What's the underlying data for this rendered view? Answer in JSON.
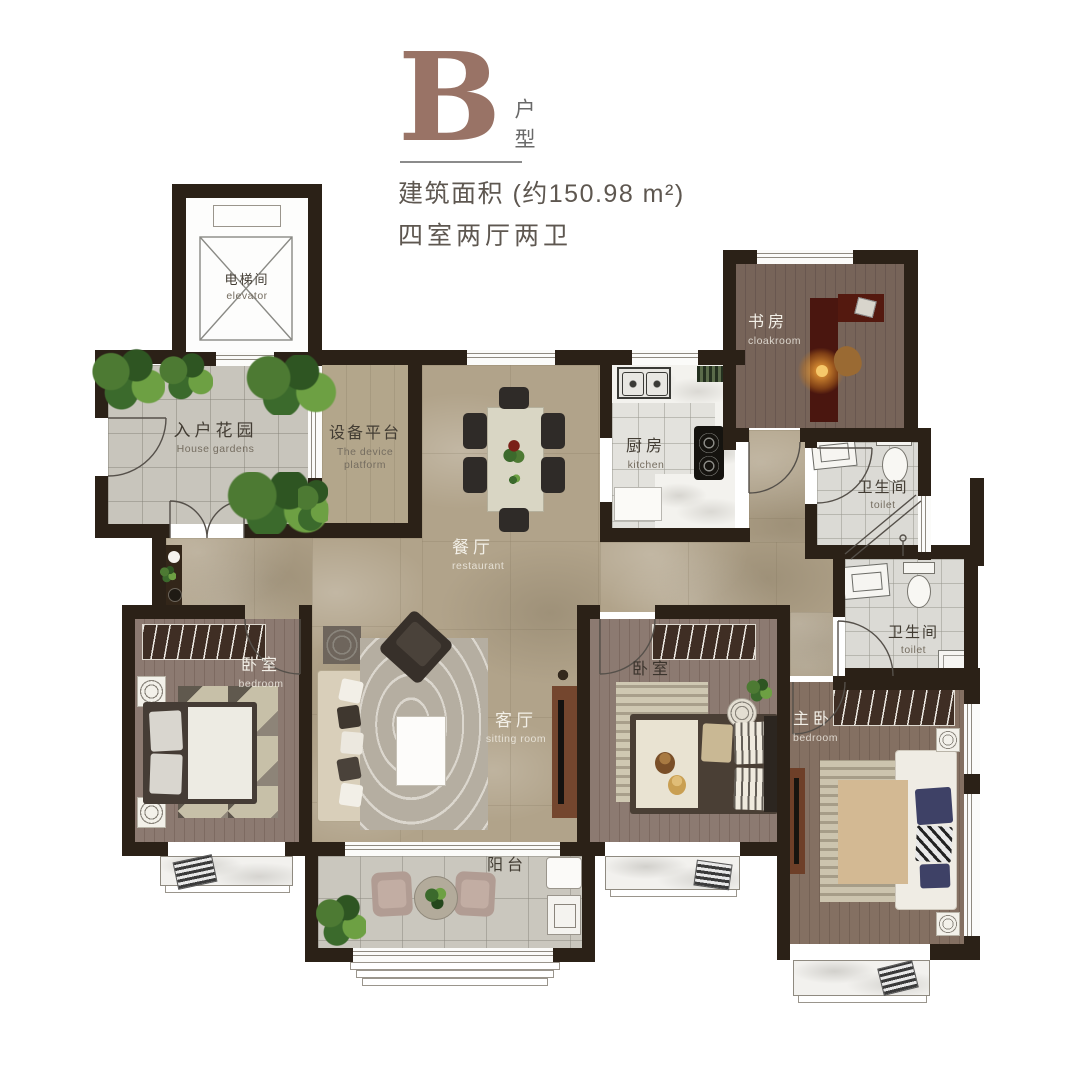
{
  "header": {
    "type_letter": "B",
    "type_label_vertical": "户型",
    "area_line": "建筑面积 (约150.98 m²)",
    "rooms_line": "四室两厅两卫"
  },
  "rooms": {
    "elevator": {
      "cn": "电梯间",
      "en": "elevator"
    },
    "house_garden": {
      "cn": "入户花园",
      "en": "House gardens"
    },
    "device_platform": {
      "cn": "设备平台",
      "en": "The device platform"
    },
    "dining": {
      "cn": "餐厅",
      "en": "restaurant"
    },
    "kitchen": {
      "cn": "厨房",
      "en": "kitchen"
    },
    "study": {
      "cn": "书房",
      "en": "cloakroom"
    },
    "bathroom_upper": {
      "cn": "卫生间",
      "en": "toilet"
    },
    "bathroom_lower": {
      "cn": "卫生间",
      "en": "toilet"
    },
    "bedroom_left": {
      "cn": "卧室",
      "en": "bedroom"
    },
    "living": {
      "cn": "客厅",
      "en": "sitting room"
    },
    "bedroom_middle": {
      "cn": "卧室"
    },
    "master_bedroom": {
      "cn": "主卧",
      "en": "bedroom"
    },
    "balcony": {
      "cn": "阳台"
    }
  },
  "colors": {
    "accent_brown": "#997366",
    "wall": "#2b2117",
    "marble_floor": "#b1a38a",
    "wood_floor": "#8c7a71",
    "label_dark": "#423c33",
    "label_light": "#f3f0e8"
  }
}
